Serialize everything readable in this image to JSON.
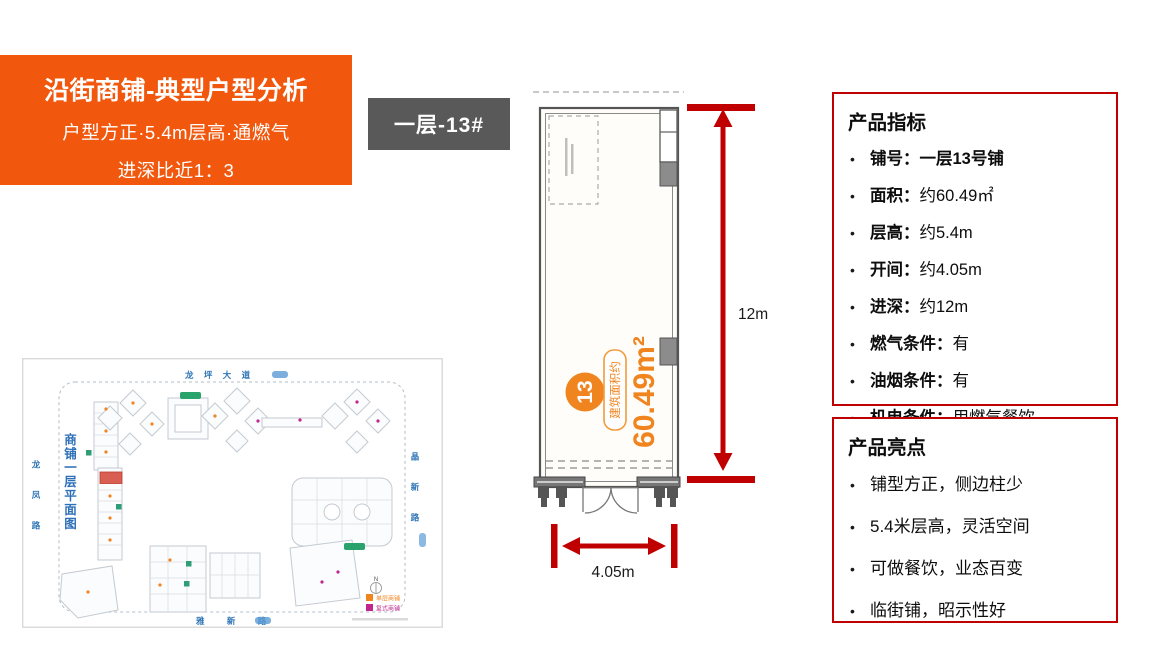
{
  "header": {
    "title": "沿街商铺-典型户型分析",
    "subtitle_line1": "户型方正·5.4m层高·通燃气",
    "subtitle_line2": "进深比近1：3"
  },
  "unit_tag": {
    "label": "一层-13#"
  },
  "floor_plan": {
    "unit_number": "13",
    "area_label": "建筑面积约",
    "area_value": "60.49m²",
    "depth_dim": "12m",
    "width_dim": "4.05m"
  },
  "indicators": {
    "title": "产品指标",
    "items": [
      {
        "label": "铺号：",
        "value": "一层13号铺",
        "bold": true
      },
      {
        "label": "面积：",
        "value": "约60.49㎡"
      },
      {
        "label": "层高：",
        "value": "约5.4m"
      },
      {
        "label": "开间：",
        "value": "约4.05m"
      },
      {
        "label": "进深：",
        "value": "约12m"
      },
      {
        "label": "燃气条件：",
        "value": "有"
      },
      {
        "label": "油烟条件：",
        "value": "有"
      },
      {
        "label": "机电条件：",
        "value": "用燃气餐饮"
      }
    ]
  },
  "highlights": {
    "title": "产品亮点",
    "items": [
      {
        "text": "铺型方正，侧边柱少"
      },
      {
        "text": "5.4米层高，灵活空间"
      },
      {
        "text": "可做餐饮，业态百变"
      },
      {
        "text": "临街铺，昭示性好"
      }
    ]
  },
  "site_plan": {
    "title": "商铺一层平面图",
    "roads": {
      "top": "龙 坪 大 道",
      "left": "龙凤路",
      "right": "晶新路",
      "bottom": "雅 新 路"
    },
    "legend": [
      {
        "label": "单层商铺",
        "color": "#F0841F"
      },
      {
        "label": "复式商铺",
        "color": "#C0268C"
      }
    ]
  },
  "colors": {
    "accent_orange": "#F1580E",
    "plan_orange": "#F0841F",
    "dimension_dark_red": "#C00000",
    "tag_gray": "#595959",
    "map_blue": "#2E75B6",
    "highlight_unit_red": "#D95F52",
    "entrance_green": "#27A36B"
  }
}
